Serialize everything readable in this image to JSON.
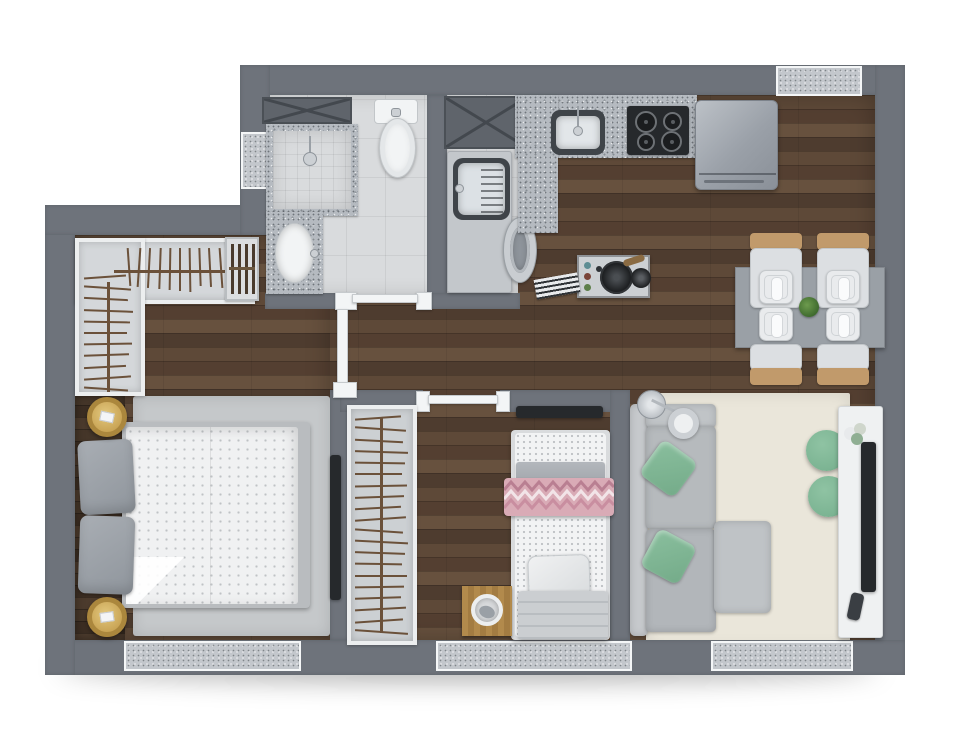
{
  "meta": {
    "type": "apartment-floor-plan-render",
    "view": "top-down",
    "text_on_image": ""
  },
  "theme": {
    "background": "#ffffff",
    "wall": "#6e737b",
    "wood_floor": "#5a4636",
    "wood_floor_dark": "#42342a",
    "tile_floor": "#d9dbdd",
    "granite": "#b5bac0",
    "rug_bedroom": "#c5c8ca",
    "rug_living": "#eae6da",
    "sofa_gray": "#b6babd",
    "pillow_green": "#8abf9e",
    "pouf_green": "#7cb493",
    "blanket_pink": "#d9abb6",
    "nightstand_gold": "#c8a354",
    "chair_tan": "#c19a6b",
    "appliance_black": "#26292c",
    "hanger_wood": "#6b513a"
  },
  "closets": {
    "hall_top_hangers": 13,
    "hall_side_hangers": 11,
    "wardrobe_hangers": 20
  },
  "dining": {
    "chairs": 4,
    "place_settings": 4,
    "centerpiece": "plant"
  },
  "rooms": [
    {
      "name": "bathroom",
      "items": [
        "overhead-cabinet",
        "shower",
        "toilet",
        "vanity-sink",
        "window"
      ]
    },
    {
      "name": "laundry",
      "items": [
        "overhead-cabinet",
        "utility-sink",
        "washing-machine"
      ]
    },
    {
      "name": "kitchen",
      "items": [
        "granite-counter",
        "sink",
        "cooktop",
        "refrigerator"
      ]
    },
    {
      "name": "dining-area",
      "items": [
        "table",
        "chairs",
        "place-settings",
        "plant"
      ]
    },
    {
      "name": "master-bedroom",
      "items": [
        "open-closet",
        "shoe-rack",
        "double-bed",
        "nightstands",
        "rug",
        "wall-tv",
        "window"
      ]
    },
    {
      "name": "second-bedroom",
      "items": [
        "wardrobe",
        "single-bed",
        "chevron-blanket",
        "side-table",
        "pet-bowl",
        "window"
      ]
    },
    {
      "name": "living-room",
      "items": [
        "l-sofa",
        "green-pillows",
        "arc-lamp",
        "rug",
        "poufs",
        "tv-console",
        "tv",
        "window"
      ]
    }
  ]
}
